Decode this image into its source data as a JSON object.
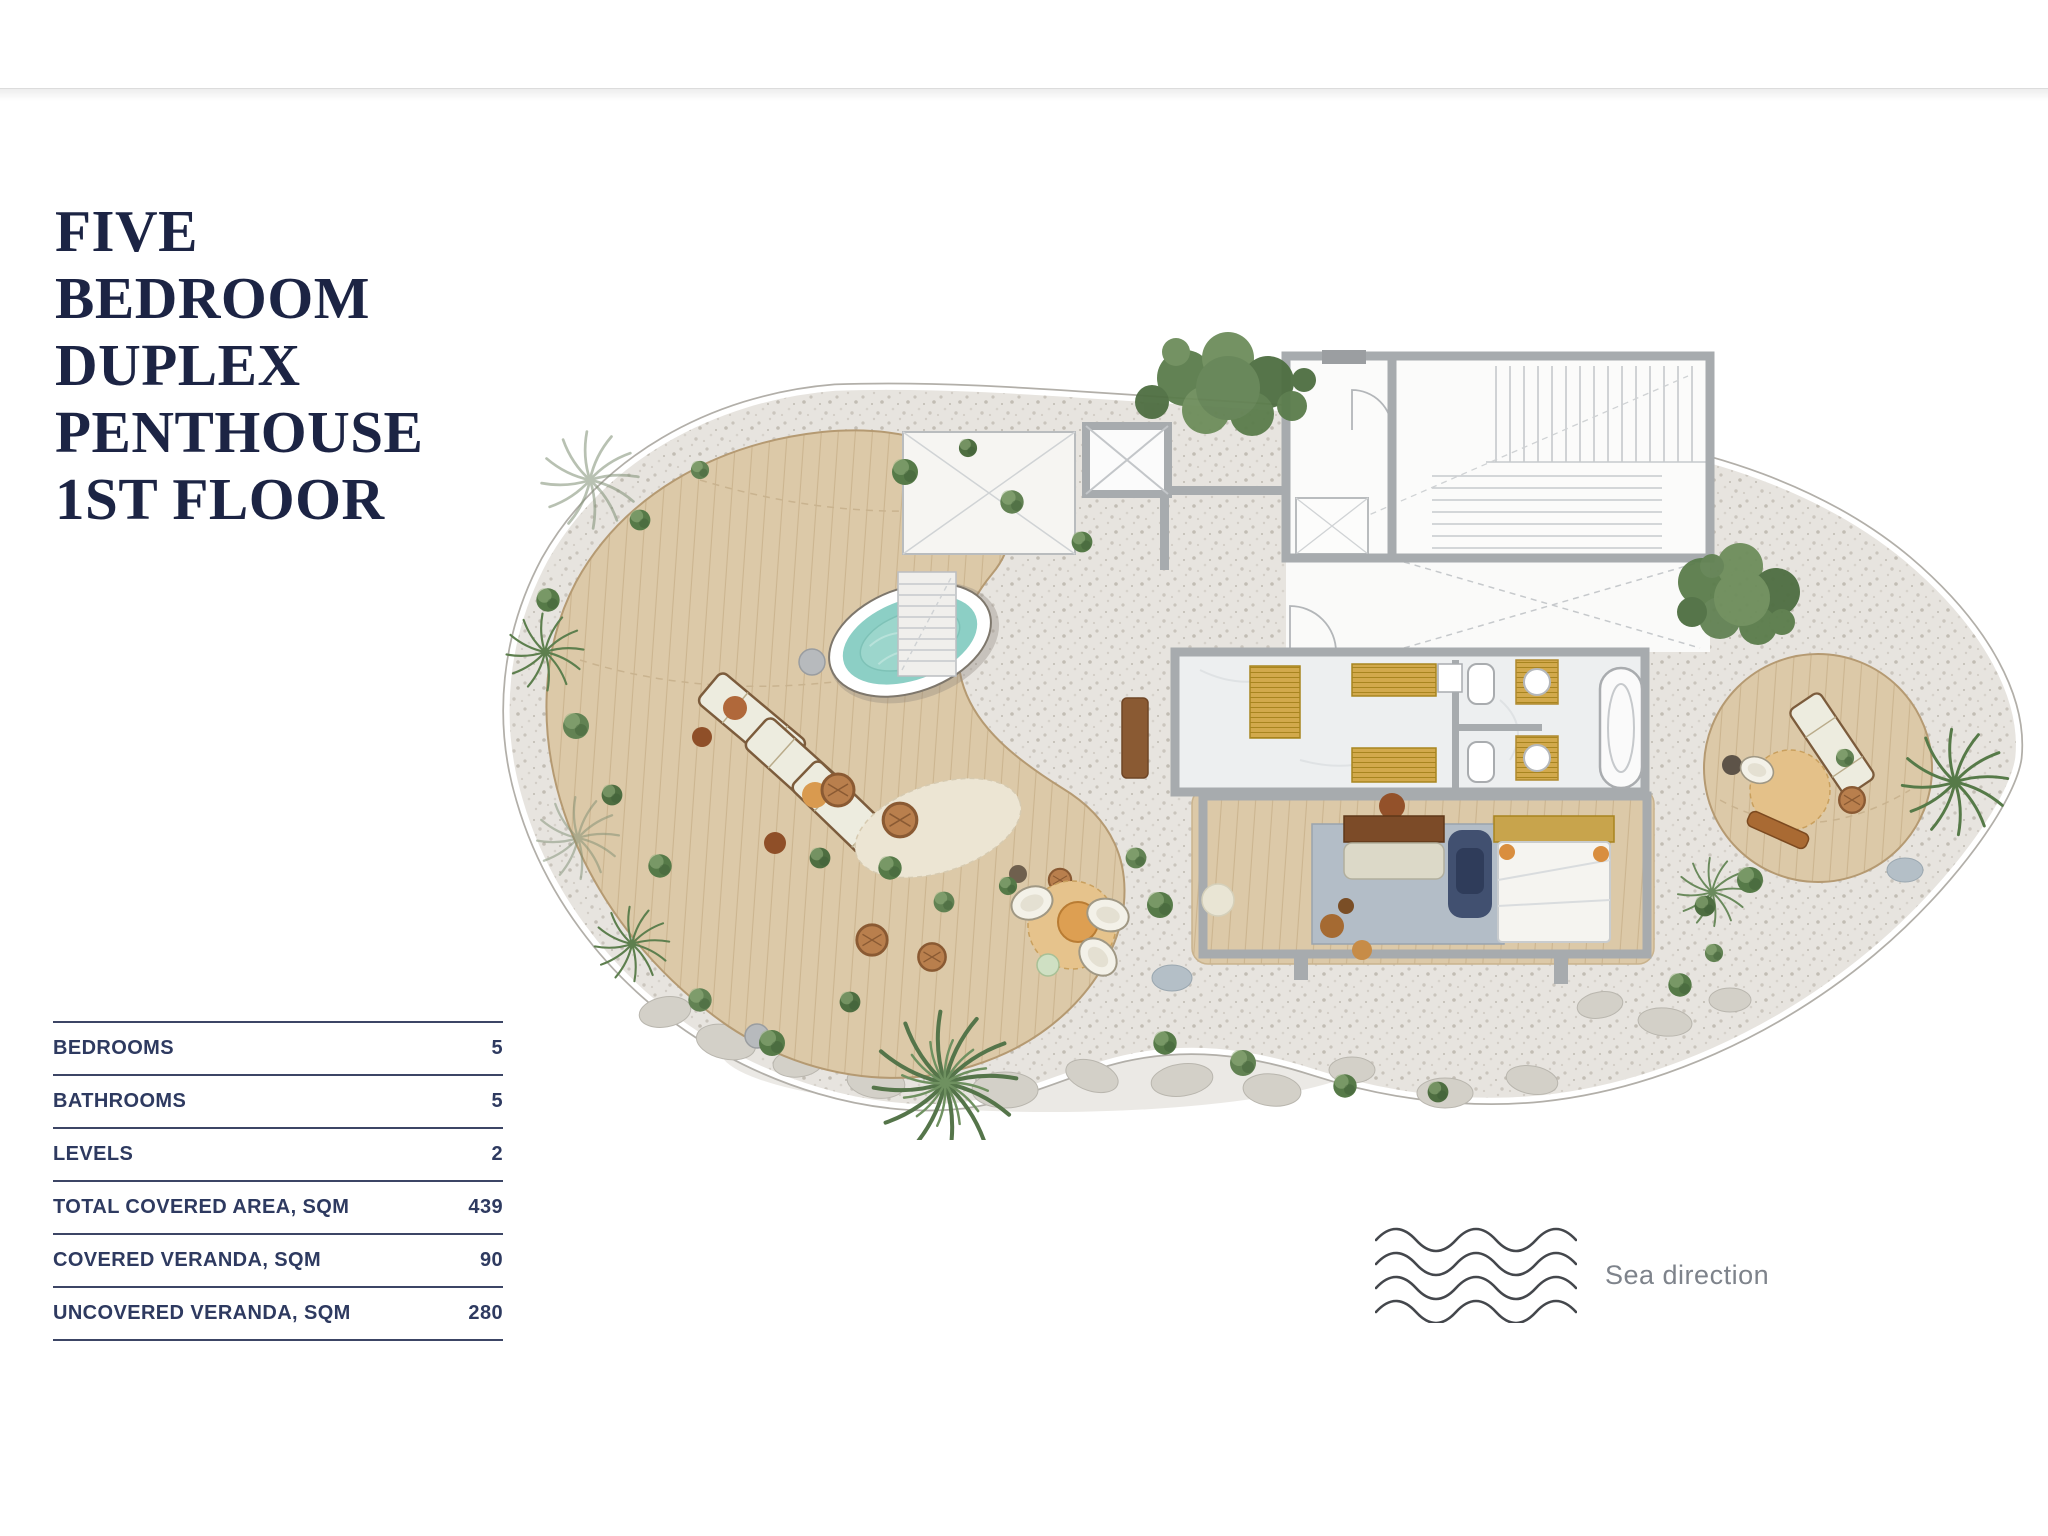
{
  "header": {
    "title_lines": [
      "FIVE",
      "BEDROOM",
      "DUPLEX",
      "PENTHOUSE",
      "1ST FLOOR"
    ],
    "title_color": "#1c2444"
  },
  "specs_table": {
    "line_color": "#3c4565",
    "text_color": "#2e3a60",
    "rows": [
      {
        "label": "BEDROOMS",
        "value": "5"
      },
      {
        "label": "BATHROOMS",
        "value": "5"
      },
      {
        "label": "LEVELS",
        "value": "2"
      },
      {
        "label": "TOTAL COVERED AREA, SQM",
        "value": "439"
      },
      {
        "label": "COVERED VERANDA, SQM",
        "value": "90"
      },
      {
        "label": "UNCOVERED VERANDA, SQM",
        "value": "280"
      }
    ]
  },
  "legend": {
    "sea_direction_label": "Sea direction",
    "icon": "waves-icon",
    "text_color": "#7e838b"
  },
  "floor_plan": {
    "type": "architectural-top-view",
    "areas": [
      "pool-deck",
      "plunge-pool",
      "sun-loungers",
      "lounge-seating",
      "stairwell",
      "elevator",
      "corridor",
      "bathroom",
      "master-bedroom",
      "sun-deck",
      "gravel-garden",
      "palm-trees"
    ],
    "colors": {
      "wood_deck": "#dcc9a8",
      "pool_water": "#8ccfc5",
      "walls": "#a7abae",
      "gravel": "#e7e4df",
      "greenery": "#567a48",
      "wardrobe_gold": "#d2a94c",
      "rug_blue": "#b3bdc7"
    }
  }
}
